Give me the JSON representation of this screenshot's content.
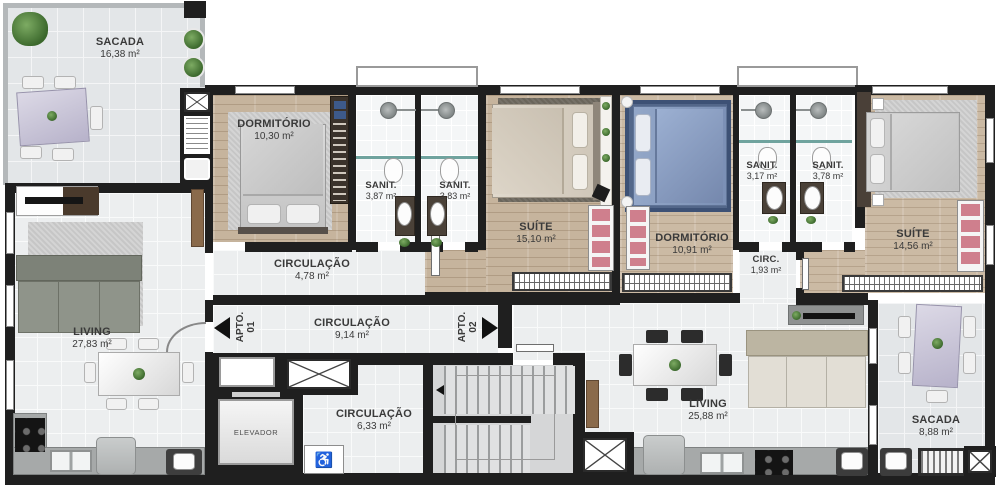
{
  "plan_type": "residential-floor-plan",
  "apartments": {
    "apto1": {
      "label": "APTO.",
      "number": "01"
    },
    "apto2": {
      "label": "APTO.",
      "number": "02"
    }
  },
  "rooms": {
    "sacada1": {
      "name": "SACADA",
      "area": "16,38 m²"
    },
    "dormitorio1": {
      "name": "DORMITÓRIO",
      "area": "10,30 m²"
    },
    "sanit1": {
      "name": "SANIT.",
      "area": "3,87 m²"
    },
    "sanit2": {
      "name": "SANIT.",
      "area": "3,83 m²"
    },
    "suite1": {
      "name": "SUÍTE",
      "area": "15,10 m²"
    },
    "circulacao1": {
      "name": "CIRCULAÇÃO",
      "area": "4,78 m²"
    },
    "living1": {
      "name": "LIVING",
      "area": "27,83 m²"
    },
    "hall": {
      "name": "CIRCULAÇÃO",
      "area": "9,14 m²"
    },
    "hall2": {
      "name": "CIRCULAÇÃO",
      "area": "6,33 m²"
    },
    "elevador": {
      "name": "ELEVADOR"
    },
    "dormitorio2": {
      "name": "DORMITÓRIO",
      "area": "10,91 m²"
    },
    "sanit3": {
      "name": "SANIT.",
      "area": "3,17 m²"
    },
    "sanit4": {
      "name": "SANIT.",
      "area": "3,78 m²"
    },
    "circ2": {
      "name": "CIRC.",
      "area": "1,93 m²"
    },
    "suite2": {
      "name": "SUÍTE",
      "area": "14,56 m²"
    },
    "living2": {
      "name": "LIVING",
      "area": "25,88 m²"
    },
    "sacada2": {
      "name": "SACADA",
      "area": "8,88 m²"
    }
  },
  "icons": {
    "wheelchair": "♿"
  },
  "colors": {
    "wall": "#1f1f1f",
    "wood_floor": "#c6b49d",
    "tile_floor": "#eceeef",
    "balcony_tile": "#e3e6e8",
    "closet_pink": "#cf7f8d",
    "bed_blue": "#8299bd",
    "bed_beige": "#d9d2c6",
    "table_lavender": "#c5c0d5",
    "sofa_green": "#8b9086",
    "shower_glass_teal": "#6fa39e",
    "door_wood": "#8a6a4b"
  }
}
